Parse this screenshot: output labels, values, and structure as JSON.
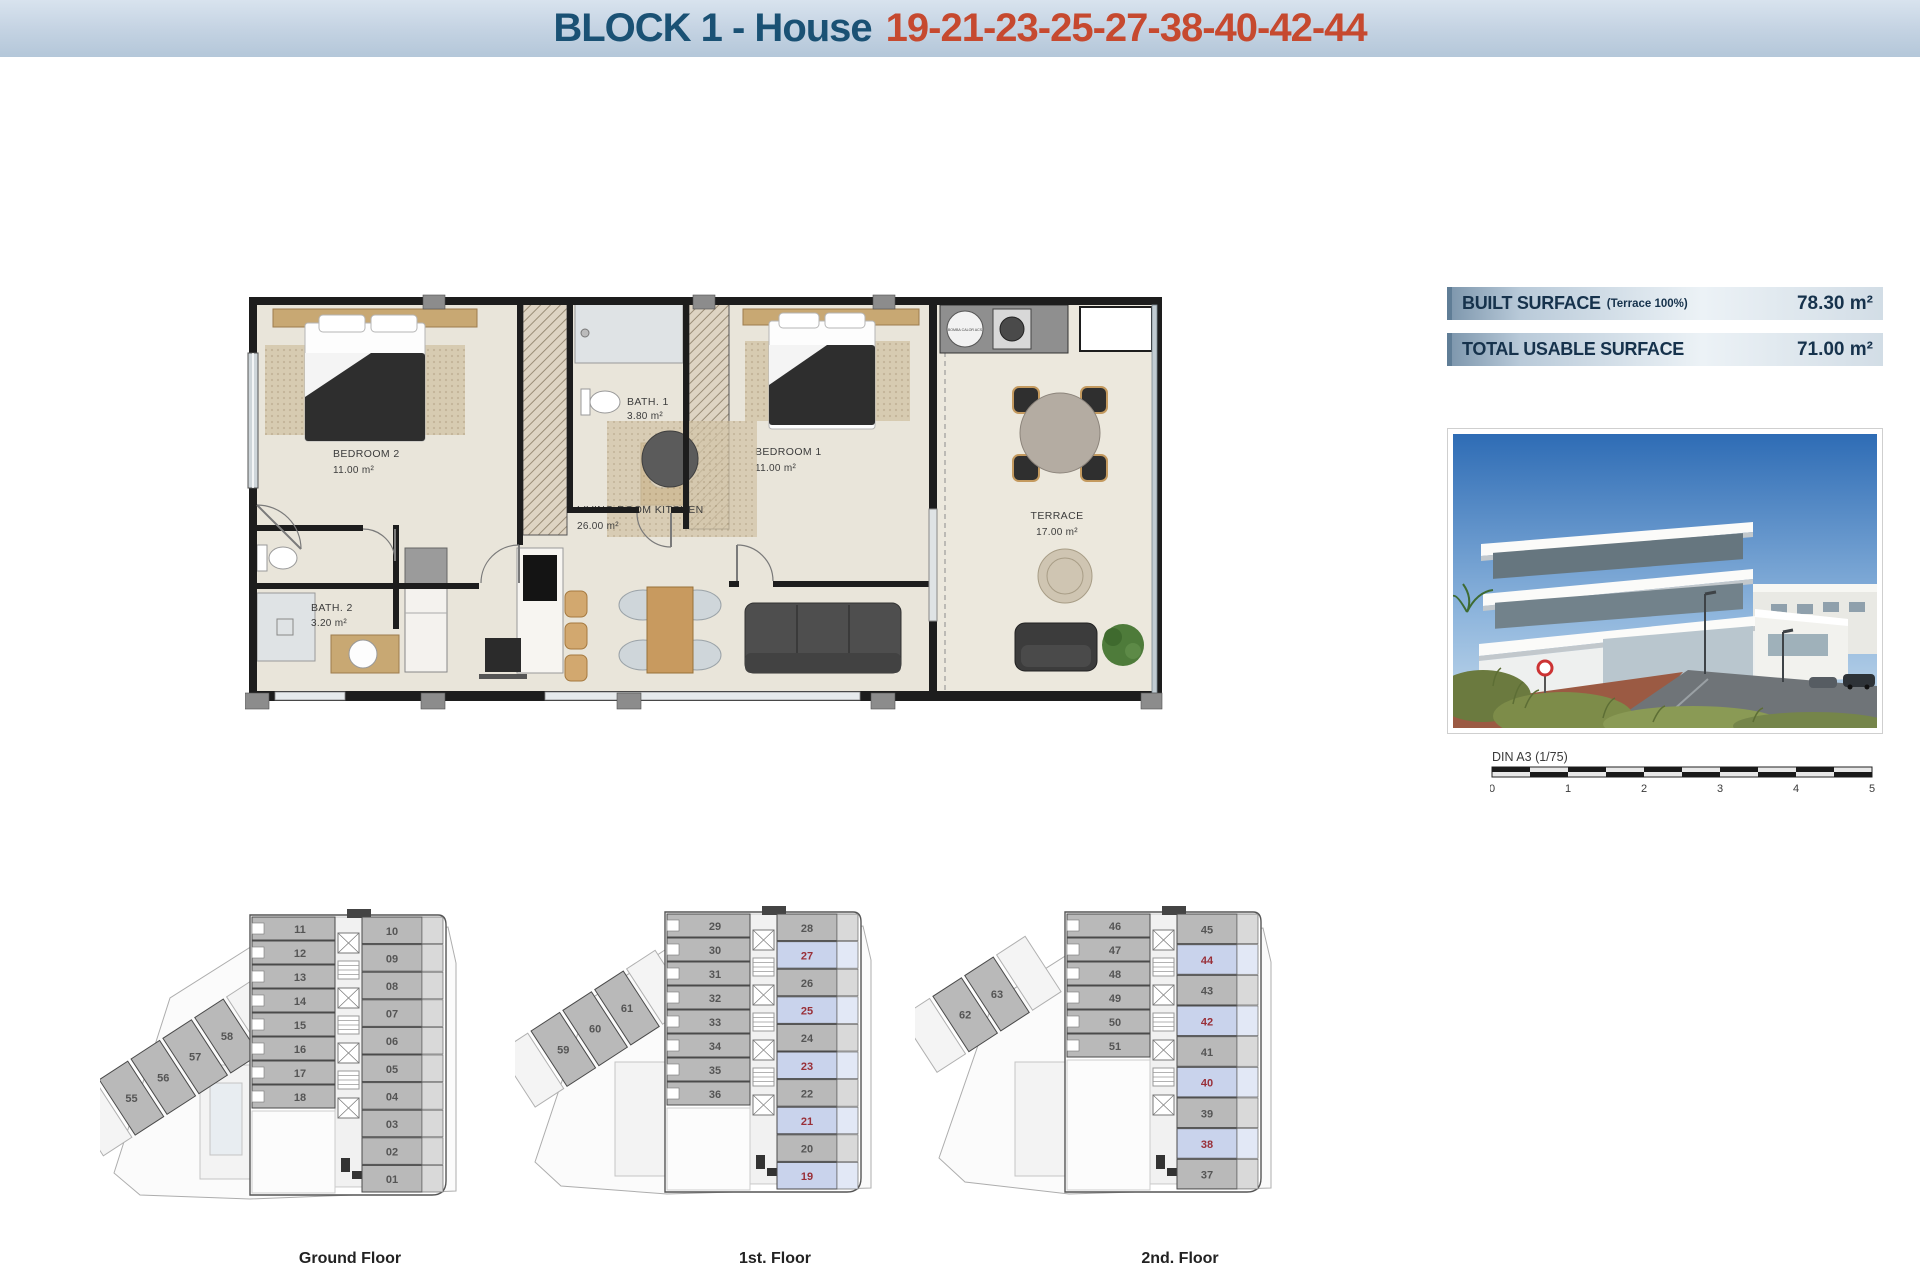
{
  "header": {
    "title": "BLOCK 1 - House",
    "title_numbers": "19-21-23-25-27-38-40-42-44"
  },
  "surface_info": {
    "rows": [
      {
        "label": "BUILT SURFACE",
        "note": "(Terrace 100%)",
        "value": "78.30 m²"
      },
      {
        "label": "TOTAL USABLE SURFACE",
        "note": "",
        "value": "71.00 m²"
      }
    ]
  },
  "floor_plan": {
    "rooms": [
      {
        "name": "BEDROOM 2",
        "area": "11.00 m²"
      },
      {
        "name": "BATH. 1",
        "area": "3.80 m²"
      },
      {
        "name": "BEDROOM 1",
        "area": "11.00 m²"
      },
      {
        "name": "LIVING ROOM KITCHEN",
        "area": "26.00 m²"
      },
      {
        "name": "BATH. 2",
        "area": "3.20 m²"
      },
      {
        "name": "TERRACE",
        "area": "17.00 m²"
      }
    ],
    "utility_label": "BOMBA CALOR ACS"
  },
  "photo": {
    "description": "Modern white apartment building with terraces, street and dune vegetation"
  },
  "scale_bar": {
    "label": "DIN A3 (1/75)",
    "ticks": [
      "0",
      "1",
      "2",
      "3",
      "4",
      "5"
    ]
  },
  "floors": [
    {
      "label": "Ground Floor",
      "left_units": [
        "11",
        "12",
        "13",
        "14",
        "15",
        "16",
        "17",
        "18"
      ],
      "right_units": [
        "10",
        "09",
        "08",
        "07",
        "06",
        "05",
        "04",
        "03",
        "02",
        "01"
      ],
      "diagonal_units": [
        "58",
        "57",
        "56",
        "55"
      ],
      "highlighted_units": []
    },
    {
      "label": "1st. Floor",
      "left_units": [
        "29",
        "30",
        "31",
        "32",
        "33",
        "34",
        "35",
        "36"
      ],
      "right_units": [
        "28",
        "27",
        "26",
        "25",
        "24",
        "23",
        "22",
        "21",
        "20",
        "19"
      ],
      "diagonal_units": [
        "61",
        "60",
        "59"
      ],
      "highlighted_units": [
        "27",
        "25",
        "23",
        "21",
        "19"
      ]
    },
    {
      "label": "2nd. Floor",
      "left_units": [
        "46",
        "47",
        "48",
        "49",
        "50",
        "51"
      ],
      "right_units": [
        "45",
        "44",
        "43",
        "42",
        "41",
        "40",
        "39",
        "38",
        "37"
      ],
      "diagonal_units": [
        "63",
        "62"
      ],
      "highlighted_units": [
        "44",
        "42",
        "40",
        "38"
      ]
    }
  ],
  "colors": {
    "title_blue": "#1a5174",
    "accent_orange": "#c6492f",
    "wall": "#1d1d1d",
    "floor_beige": "#e9e5da",
    "unit_gray": "#b9b9b9",
    "highlight_fill": "#c9d3ec",
    "highlight_text": "#992f38",
    "surface_text": "#16324c"
  }
}
